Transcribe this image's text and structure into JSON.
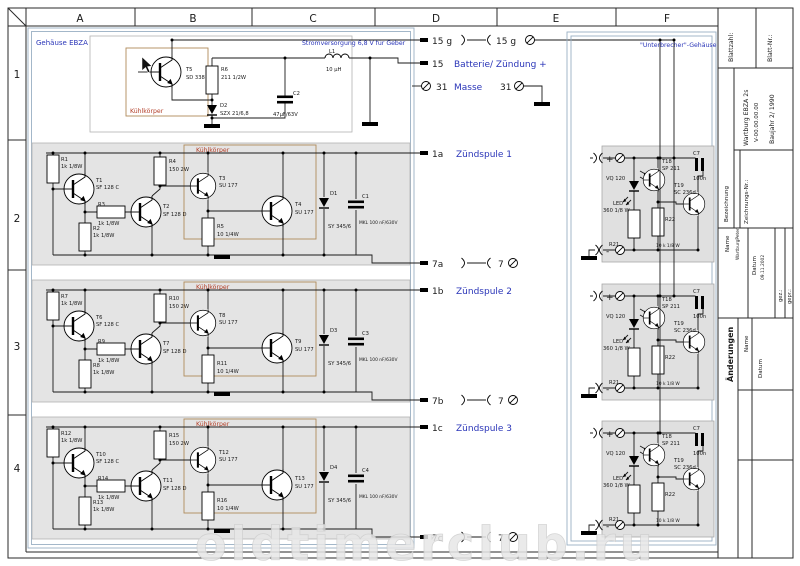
{
  "frame": {
    "columns": [
      "A",
      "B",
      "C",
      "D",
      "E",
      "F"
    ],
    "rows": [
      "1",
      "2",
      "3",
      "4"
    ]
  },
  "housing": {
    "label": "Gehäuse EBZA"
  },
  "supply": {
    "title": "Stromversorgung 6,8 V für Geber",
    "heatsink": "Kühlkörper",
    "t5": "T5",
    "t5v": "SD 338",
    "r6": "R6",
    "r6v": "211 1/2W",
    "d2": "D2",
    "d2v": "SZX 21/6,8",
    "c2": "C2",
    "c2v": "47µF/63V",
    "l1": "L1",
    "l1v": "10 µH"
  },
  "channels": [
    {
      "heatsink": "Kühlkörper",
      "r1": "R1",
      "r1v": "1k 1/8W",
      "t1": "T1",
      "t1v": "SF 128 C",
      "r3": "R3",
      "r3v": "1k 1/8W",
      "r2": "R2",
      "r2v": "1k 1/8W",
      "r4": "R4",
      "r4v": "150  2W",
      "t2": "T2",
      "t2v": "SF 128 D",
      "t3": "T3",
      "t3v": "SU 177",
      "r5": "R5",
      "r5v": "10 1/4W",
      "t4": "T4",
      "t4v": "SU 177",
      "d": "D1",
      "dv": "SY 345/6",
      "c": "C1",
      "cv": "MKL 100 nF/630V"
    },
    {
      "heatsink": "Kühlkörper",
      "r1": "R7",
      "r1v": "1k 1/8W",
      "t1": "T6",
      "t1v": "SF 128 C",
      "r3": "R9",
      "r3v": "1k 1/8W",
      "r2": "R8",
      "r2v": "1k 1/8W",
      "r4": "R10",
      "r4v": "150  2W",
      "t2": "T7",
      "t2v": "SF 128 D",
      "t3": "T8",
      "t3v": "SU 177",
      "r5": "R11",
      "r5v": "10 1/4W",
      "t4": "T9",
      "t4v": "SU 177",
      "d": "D3",
      "dv": "SY 345/6",
      "c": "C3",
      "cv": "MKL 100 nF/630V"
    },
    {
      "heatsink": "Kühlkörper",
      "r1": "R12",
      "r1v": "1k 1/8W",
      "t1": "T10",
      "t1v": "SF 128 C",
      "r3": "R14",
      "r3v": "1k 1/8W",
      "r2": "R13",
      "r2v": "1k 1/8W",
      "r4": "R15",
      "r4v": "150  2W",
      "t2": "T11",
      "t2v": "SF 128 D",
      "t3": "T12",
      "t3v": "SU 177",
      "r5": "R16",
      "r5v": "10 1/4W",
      "t4": "T13",
      "t4v": "SU 177",
      "d": "D4",
      "dv": "SY 345/6",
      "c": "C4",
      "cv": "MKL 100 nF/630V"
    }
  ],
  "terminals": {
    "g15_left": "15 g",
    "g15_right": "15 g",
    "b15": "15",
    "b15_label": "Batterie/ Zündung +",
    "m31": "31",
    "m31_label": "Masse",
    "m31_right": "31",
    "outs": [
      {
        "pin": "1a",
        "label": "Zündspule 1",
        "ret": "7a",
        "seven": "7"
      },
      {
        "pin": "1b",
        "label": "Zündspule 2",
        "ret": "7b",
        "seven": "7"
      },
      {
        "pin": "1c",
        "label": "Zündspule 3",
        "ret": "7c",
        "seven": "7"
      }
    ]
  },
  "breaker": {
    "label": "\"Unterbrecher\"-Gehäuse",
    "plus": "+",
    "minus": "-",
    "vq": "VQ 120",
    "led1": "LED",
    "led2": "360 1/8 W",
    "r21": "R21",
    "t18": "T18",
    "t18v": "SP 211",
    "r22": "R22",
    "r22v": "10 k 1/8 W",
    "t19": "T19",
    "t19v": "SC 236d",
    "c7": "C7",
    "c7v": "100n"
  },
  "titleblock": {
    "blattzahl": "Blattzahl:",
    "blattnr": "Blatt-Nr.:",
    "bezeichnung": "Bezeichnung",
    "zeichnungsnr": "Zeichnungs-Nr.:",
    "title1": "Wartburg EBZA 2s",
    "title2": "V-00.00.00.00",
    "title3": "Baujahr 2/ 1990",
    "name_label": "Name",
    "name_value": "WartburgPeter",
    "datum_label": "Datum",
    "datum_value": "09.11.2002",
    "gez": "gez.:",
    "gepr": "gepr.:",
    "aenderungen": "Änderungen",
    "a_name": "Name",
    "a_datum": "Datum"
  },
  "watermark": "oldtimerclub.ru",
  "colors": {
    "label_blue": "#2a35b8",
    "heatsink_red": "#b3402a",
    "heatsink_box": "#b08a5a",
    "housing_line": "#9ab0c4",
    "channel_fill": "#e4e4e4"
  }
}
